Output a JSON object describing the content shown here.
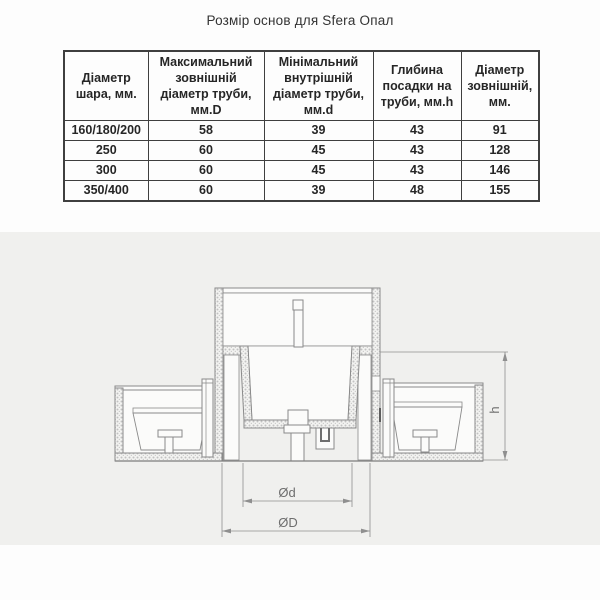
{
  "title": "Розмір основ для Sfera Опал",
  "table": {
    "headers": [
      "Діаметр шара, мм.",
      "Максимальний зовнішній діаметр труби, мм.D",
      "Мінімальний внутрішній діаметр труби, мм.d",
      "Глибина посадки на труби, мм.h",
      "Діаметр зовнішній, мм."
    ],
    "rows": [
      [
        "160/180/200",
        "58",
        "39",
        "43",
        "91"
      ],
      [
        "250",
        "60",
        "45",
        "43",
        "128"
      ],
      [
        "300",
        "60",
        "45",
        "43",
        "146"
      ],
      [
        "350/400",
        "60",
        "39",
        "48",
        "155"
      ]
    ]
  },
  "diagram": {
    "labels": {
      "inner_diameter": "Ød",
      "outer_diameter": "ØD",
      "height": "h"
    },
    "colors": {
      "band_background": "#f0f0ee",
      "line": "#8a8a8a",
      "dimension_line": "#8f8f8f"
    }
  }
}
